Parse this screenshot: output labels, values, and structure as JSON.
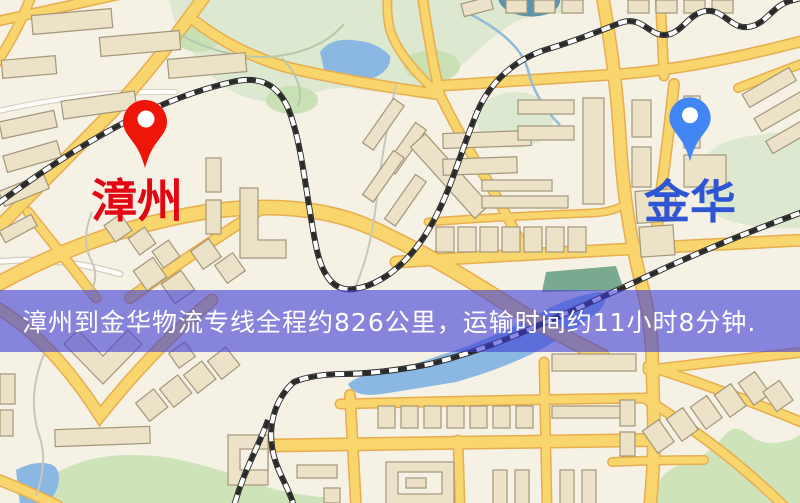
{
  "banner": {
    "text": "漳州到金华物流专线全程约826公里，运输时间约11小时8分钟.",
    "bg": "rgba(62,60,214,0.60)",
    "text_color": "#ffffff"
  },
  "markers": {
    "origin": {
      "label": "漳州",
      "label_color": "#e30613",
      "pin_color": "#ee1509"
    },
    "destination": {
      "label": "金华",
      "label_color": "#2f55d4",
      "pin_color": "#4285f4"
    }
  },
  "map_colors": {
    "background": "#f5f1e4",
    "road_fill": "#f8d66d",
    "road_casing": "#e7ad4f",
    "park": "#dce8d0",
    "water": "#8ab8e2",
    "building": "#ece2c8",
    "railway": "#2a2a2a"
  }
}
